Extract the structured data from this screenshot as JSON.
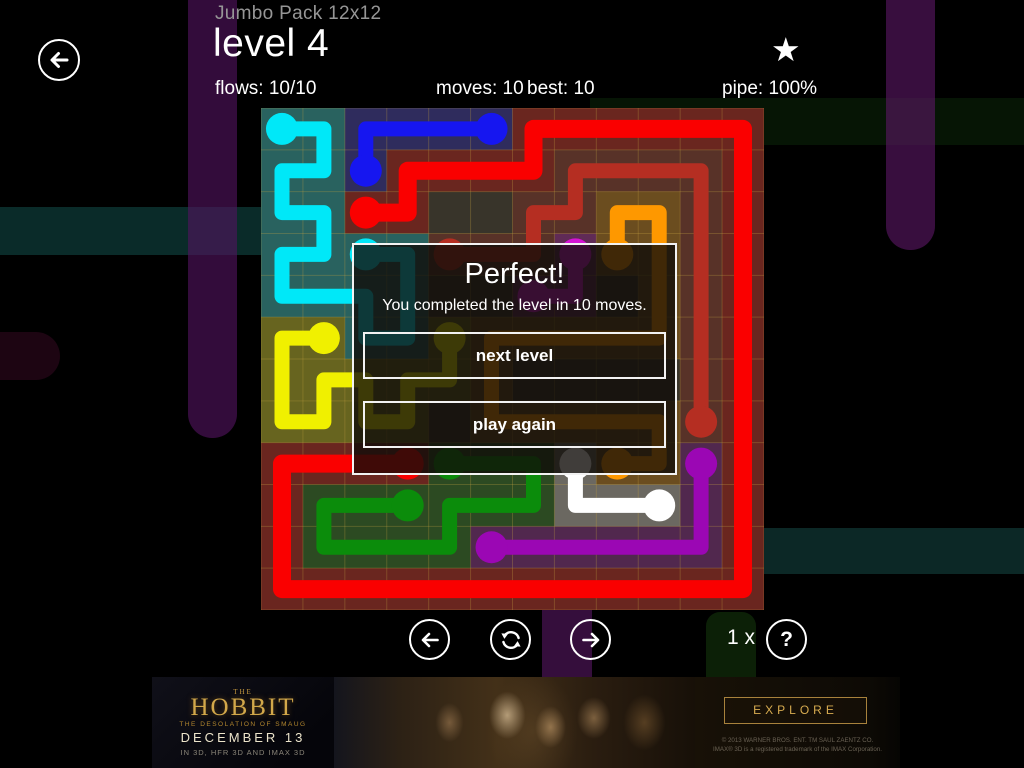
{
  "header": {
    "pack": "Jumbo Pack 12x12",
    "level": "level 4",
    "flows": "flows: 10/10",
    "moves": "moves: 10",
    "best": "best: 10",
    "pipe": "pipe: 100%",
    "star_icon": "★"
  },
  "dialog": {
    "title": "Perfect!",
    "message": "You completed the level in 10 moves.",
    "next_label": "next level",
    "again_label": "play again"
  },
  "footer": {
    "hint_count": "1 x",
    "help_glyph": "?"
  },
  "ad": {
    "brand_the": "THE",
    "brand": "HOBBIT",
    "tagline": "THE DESOLATION OF SMAUG",
    "date": "DECEMBER 13",
    "formats": "IN 3D, HFR 3D AND IMAX 3D",
    "explore": "EXPLORE",
    "copyright1": "© 2013 WARNER BROS. ENT. TM SAUL ZAENTZ CO.",
    "copyright2": "IMAX® 3D is a registered trademark of the IMAX Corporation."
  },
  "background": {
    "bands": [
      {
        "name": "teal-band-left",
        "x": 0,
        "y": 207,
        "w": 261,
        "h": 48,
        "r": "0",
        "color": "#0a2b29"
      },
      {
        "name": "green-band-right",
        "x": 590,
        "y": 98,
        "w": 434,
        "h": 47,
        "r": "0",
        "color": "#061505"
      },
      {
        "name": "teal-band-bottom",
        "x": 758,
        "y": 528,
        "w": 266,
        "h": 46,
        "r": "0",
        "color": "#0c2826"
      },
      {
        "name": "green-stub-bottom",
        "x": 706,
        "y": 612,
        "w": 50,
        "h": 65,
        "r": "14px 14px 0 0",
        "color": "#0c2007"
      },
      {
        "name": "purple-stub-bottom",
        "x": 542,
        "y": 608,
        "w": 50,
        "h": 69,
        "r": "0",
        "color": "rgba(62,17,70,0.85)"
      },
      {
        "name": "purple-band-left",
        "x": 188,
        "y": 0,
        "w": 49,
        "h": 438,
        "r": "0 0 24px 24px",
        "color": "rgba(82,20,96,0.62)"
      },
      {
        "name": "purple-band-right",
        "x": 886,
        "y": 0,
        "w": 49,
        "h": 250,
        "r": "0 0 24px 24px",
        "color": "rgba(90,22,100,0.62)"
      },
      {
        "name": "maroon-stub-left",
        "x": 0,
        "y": 332,
        "w": 60,
        "h": 48,
        "r": "0 24px 24px 0",
        "color": "#1d0512"
      }
    ]
  },
  "board": {
    "cols": 12,
    "rows": 12,
    "bg": "#38342a",
    "grid_color": "rgba(205,170,70,0.28)",
    "tint_opacity": 0.26,
    "dot_radius": 16,
    "flows": [
      {
        "name": "red",
        "color": "#fa0000",
        "width": 18,
        "points": [
          [
            2,
            2
          ],
          [
            3,
            2
          ],
          [
            3,
            1
          ],
          [
            6,
            1
          ],
          [
            6,
            0
          ],
          [
            11,
            0
          ],
          [
            11,
            11
          ],
          [
            0,
            11
          ],
          [
            0,
            8
          ],
          [
            3,
            8
          ]
        ]
      },
      {
        "name": "blue",
        "color": "#1616f0",
        "width": 15,
        "points": [
          [
            2,
            1
          ],
          [
            2,
            0
          ],
          [
            5,
            0
          ]
        ]
      },
      {
        "name": "cyan",
        "color": "#00e8f8",
        "width": 15,
        "points": [
          [
            0,
            0
          ],
          [
            1,
            0
          ],
          [
            1,
            1
          ],
          [
            0,
            1
          ],
          [
            0,
            2
          ],
          [
            1,
            2
          ],
          [
            1,
            3
          ],
          [
            0,
            3
          ],
          [
            0,
            4
          ],
          [
            2,
            4
          ],
          [
            2,
            5
          ],
          [
            3,
            5
          ],
          [
            3,
            3
          ],
          [
            2,
            3
          ]
        ]
      },
      {
        "name": "yellow",
        "color": "#f0f000",
        "width": 15,
        "points": [
          [
            1,
            5
          ],
          [
            0,
            5
          ],
          [
            0,
            7
          ],
          [
            1,
            7
          ],
          [
            1,
            6
          ],
          [
            2,
            6
          ],
          [
            2,
            7
          ],
          [
            3,
            7
          ],
          [
            3,
            6
          ],
          [
            4,
            6
          ],
          [
            4,
            5
          ]
        ]
      },
      {
        "name": "maroon",
        "color": "#b52e22",
        "width": 15,
        "points": [
          [
            4,
            3
          ],
          [
            6,
            3
          ],
          [
            6,
            2
          ],
          [
            7,
            2
          ],
          [
            7,
            1
          ],
          [
            10,
            1
          ],
          [
            10,
            7
          ]
        ]
      },
      {
        "name": "orange",
        "color": "#fe9800",
        "width": 15,
        "points": [
          [
            8,
            3
          ],
          [
            8,
            2
          ],
          [
            9,
            2
          ],
          [
            9,
            5
          ],
          [
            5,
            5
          ],
          [
            5,
            7
          ],
          [
            9,
            7
          ],
          [
            9,
            8
          ],
          [
            8,
            8
          ]
        ]
      },
      {
        "name": "magenta",
        "color": "#d414d4",
        "width": 15,
        "points": [
          [
            7,
            3
          ],
          [
            7,
            4
          ],
          [
            6,
            4
          ]
        ]
      },
      {
        "name": "green",
        "color": "#0b8c0b",
        "width": 15,
        "points": [
          [
            3,
            9
          ],
          [
            1,
            9
          ],
          [
            1,
            10
          ],
          [
            4,
            10
          ],
          [
            4,
            9
          ],
          [
            6,
            9
          ],
          [
            6,
            8
          ],
          [
            4,
            8
          ]
        ]
      },
      {
        "name": "purple",
        "color": "#9b07b4",
        "width": 15,
        "points": [
          [
            5,
            10
          ],
          [
            10,
            10
          ],
          [
            10,
            8
          ]
        ]
      },
      {
        "name": "white",
        "color": "#ffffff",
        "width": 15,
        "points": [
          [
            7,
            8
          ],
          [
            7,
            9
          ],
          [
            9,
            9
          ]
        ]
      }
    ]
  }
}
